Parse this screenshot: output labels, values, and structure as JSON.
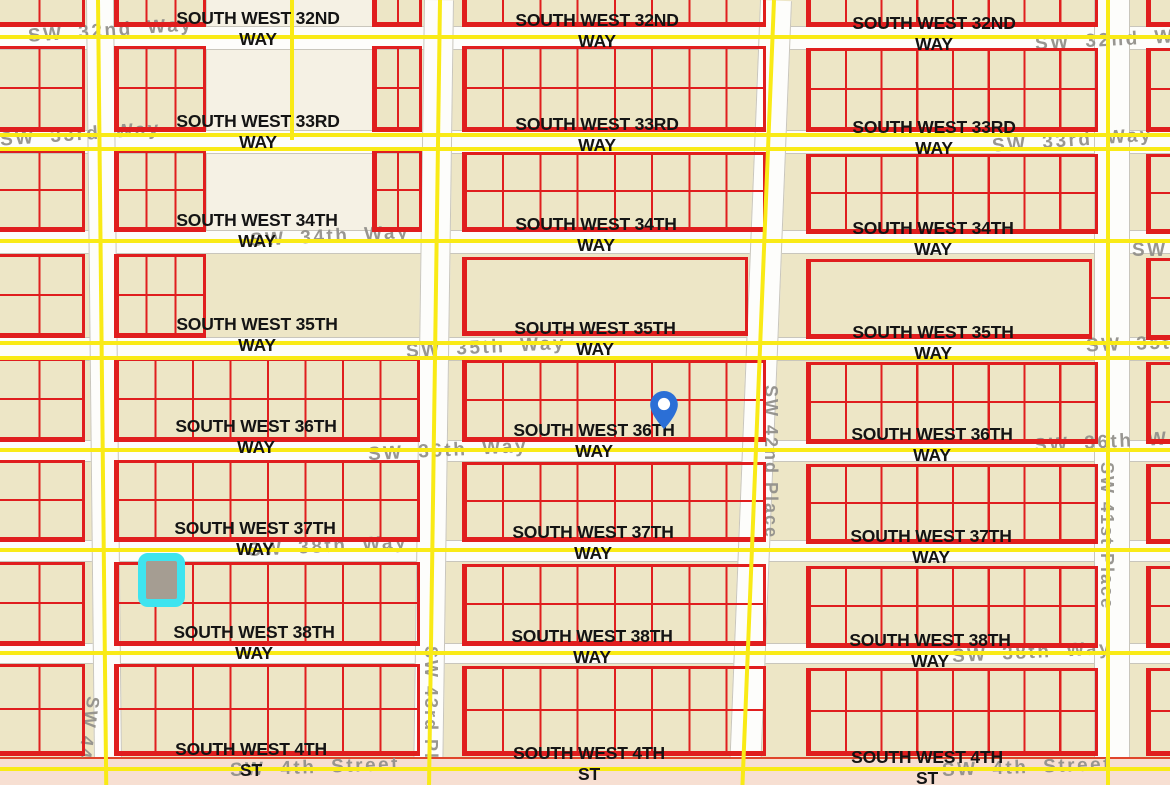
{
  "map": {
    "background": "#EDE6C6",
    "colors": {
      "parcel_red": "#E01E1E",
      "overlay_yellow": "#F9EA16",
      "street_white": "#FDFDFB",
      "street_casing_gray": "#C9C6BC",
      "bottom_street_salmon": "#F7DFD2",
      "bottom_street_casing": "#E0452B",
      "black_label": "#141414",
      "gray_label": "#93918C",
      "pin_blue": "#2B6FD6",
      "highlight_cyan": "#3EE4EF",
      "highlight_fill": "#A59D92"
    },
    "streets_h": [
      {
        "y": 26,
        "h": 22
      },
      {
        "y": 130,
        "h": 22
      },
      {
        "y": 230,
        "h": 22
      },
      {
        "y": 337,
        "h": 22
      },
      {
        "y": 440,
        "h": 20
      },
      {
        "y": 540,
        "h": 20
      },
      {
        "y": 643,
        "h": 19
      }
    ],
    "streets_v": [
      {
        "x": 86,
        "w": 26,
        "rot": -0.6
      },
      {
        "x": 424,
        "w": 28,
        "rot": 0.8
      },
      {
        "x": 760,
        "w": 30,
        "rot": 2.3
      },
      {
        "x": 1094,
        "w": 34,
        "rot": 0
      }
    ],
    "top_strip": {
      "x": 206,
      "y": 0,
      "w": 166,
      "h": 240
    },
    "bottom_street": {
      "y": 757,
      "h": 28
    },
    "yellow_h": [
      35,
      133,
      147,
      239,
      341,
      356,
      448,
      548,
      651,
      767
    ],
    "yellow_v": [
      {
        "x": 96,
        "y": 0,
        "h": 790,
        "rot": -0.6
      },
      {
        "x": 290,
        "y": 0,
        "h": 140,
        "rot": 0
      },
      {
        "x": 438,
        "y": 0,
        "h": 790,
        "rot": 0.8
      },
      {
        "x": 772,
        "y": 0,
        "h": 790,
        "rot": 2.3
      },
      {
        "x": 1106,
        "y": 0,
        "h": 790,
        "rot": 0
      }
    ],
    "blocks": [
      {
        "x": -8,
        "y": -6,
        "w": 93,
        "h": 33,
        "cols": 2,
        "rows": 1
      },
      {
        "x": 114,
        "y": -6,
        "w": 92,
        "h": 33,
        "cols": 3,
        "rows": 1
      },
      {
        "x": 372,
        "y": -6,
        "w": 50,
        "h": 33,
        "cols": 2,
        "rows": 1
      },
      {
        "x": 462,
        "y": -6,
        "w": 304,
        "h": 33,
        "cols": 8,
        "rows": 1
      },
      {
        "x": 806,
        "y": -6,
        "w": 292,
        "h": 33,
        "cols": 8,
        "rows": 1
      },
      {
        "x": 1146,
        "y": -6,
        "w": 30,
        "h": 33,
        "cols": 1,
        "rows": 1
      },
      {
        "x": -8,
        "y": 46,
        "w": 93,
        "h": 86,
        "cols": 2,
        "rows": 2
      },
      {
        "x": 114,
        "y": 46,
        "w": 92,
        "h": 86,
        "cols": 3,
        "rows": 2
      },
      {
        "x": 372,
        "y": 46,
        "w": 50,
        "h": 86,
        "cols": 2,
        "rows": 2
      },
      {
        "x": 462,
        "y": 46,
        "w": 304,
        "h": 86,
        "cols": 8,
        "rows": 2
      },
      {
        "x": 806,
        "y": 48,
        "w": 292,
        "h": 84,
        "cols": 8,
        "rows": 2
      },
      {
        "x": 1146,
        "y": 48,
        "w": 30,
        "h": 84,
        "cols": 1,
        "rows": 2
      },
      {
        "x": -8,
        "y": 150,
        "w": 93,
        "h": 82,
        "cols": 2,
        "rows": 2
      },
      {
        "x": 114,
        "y": 150,
        "w": 92,
        "h": 82,
        "cols": 3,
        "rows": 2
      },
      {
        "x": 372,
        "y": 150,
        "w": 50,
        "h": 82,
        "cols": 2,
        "rows": 2
      },
      {
        "x": 462,
        "y": 152,
        "w": 304,
        "h": 80,
        "cols": 8,
        "rows": 2
      },
      {
        "x": 806,
        "y": 154,
        "w": 292,
        "h": 80,
        "cols": 8,
        "rows": 2
      },
      {
        "x": 1146,
        "y": 154,
        "w": 30,
        "h": 80,
        "cols": 1,
        "rows": 2
      },
      {
        "x": -8,
        "y": 254,
        "w": 93,
        "h": 84,
        "cols": 2,
        "rows": 2
      },
      {
        "x": 114,
        "y": 254,
        "w": 92,
        "h": 84,
        "cols": 3,
        "rows": 2
      },
      {
        "x": 462,
        "y": 257,
        "w": 286,
        "h": 79,
        "cols": 1,
        "rows": 1
      },
      {
        "x": 806,
        "y": 259,
        "w": 286,
        "h": 80,
        "cols": 1,
        "rows": 1
      },
      {
        "x": 1146,
        "y": 258,
        "w": 30,
        "h": 82,
        "cols": 1,
        "rows": 2
      },
      {
        "x": -8,
        "y": 358,
        "w": 93,
        "h": 84,
        "cols": 2,
        "rows": 2
      },
      {
        "x": 114,
        "y": 358,
        "w": 306,
        "h": 84,
        "cols": 8,
        "rows": 2
      },
      {
        "x": 462,
        "y": 360,
        "w": 304,
        "h": 82,
        "cols": 8,
        "rows": 2
      },
      {
        "x": 806,
        "y": 362,
        "w": 292,
        "h": 82,
        "cols": 8,
        "rows": 2
      },
      {
        "x": 1146,
        "y": 362,
        "w": 30,
        "h": 82,
        "cols": 1,
        "rows": 2
      },
      {
        "x": -8,
        "y": 460,
        "w": 93,
        "h": 82,
        "cols": 2,
        "rows": 2
      },
      {
        "x": 114,
        "y": 460,
        "w": 306,
        "h": 82,
        "cols": 8,
        "rows": 2
      },
      {
        "x": 462,
        "y": 462,
        "w": 304,
        "h": 80,
        "cols": 8,
        "rows": 2
      },
      {
        "x": 806,
        "y": 464,
        "w": 292,
        "h": 80,
        "cols": 8,
        "rows": 2
      },
      {
        "x": 1146,
        "y": 464,
        "w": 30,
        "h": 80,
        "cols": 1,
        "rows": 2
      },
      {
        "x": -8,
        "y": 562,
        "w": 93,
        "h": 84,
        "cols": 2,
        "rows": 2
      },
      {
        "x": 114,
        "y": 562,
        "w": 306,
        "h": 84,
        "cols": 8,
        "rows": 2
      },
      {
        "x": 462,
        "y": 564,
        "w": 304,
        "h": 82,
        "cols": 8,
        "rows": 2
      },
      {
        "x": 806,
        "y": 566,
        "w": 292,
        "h": 82,
        "cols": 8,
        "rows": 2
      },
      {
        "x": 1146,
        "y": 566,
        "w": 30,
        "h": 82,
        "cols": 1,
        "rows": 2
      },
      {
        "x": -8,
        "y": 664,
        "w": 93,
        "h": 92,
        "cols": 2,
        "rows": 2
      },
      {
        "x": 114,
        "y": 664,
        "w": 306,
        "h": 92,
        "cols": 8,
        "rows": 2
      },
      {
        "x": 462,
        "y": 666,
        "w": 304,
        "h": 90,
        "cols": 8,
        "rows": 2
      },
      {
        "x": 806,
        "y": 668,
        "w": 292,
        "h": 88,
        "cols": 8,
        "rows": 2
      },
      {
        "x": 1146,
        "y": 668,
        "w": 30,
        "h": 88,
        "cols": 1,
        "rows": 2
      }
    ],
    "labels_black": [
      {
        "line1": "SOUTH WEST 32ND",
        "line2": "WAY",
        "cx": 258,
        "y": 8
      },
      {
        "line1": "SOUTH WEST 32ND",
        "line2": "WAY",
        "cx": 597,
        "y": 10
      },
      {
        "line1": "SOUTH WEST 32ND",
        "line2": "WAY",
        "cx": 934,
        "y": 13
      },
      {
        "line1": "SOUTH WEST 33RD",
        "line2": "WAY",
        "cx": 258,
        "y": 111
      },
      {
        "line1": "SOUTH WEST 33RD",
        "line2": "WAY",
        "cx": 597,
        "y": 114
      },
      {
        "line1": "SOUTH WEST 33RD",
        "line2": "WAY",
        "cx": 934,
        "y": 117
      },
      {
        "line1": "SOUTH WEST 34TH",
        "line2": "WAY",
        "cx": 257,
        "y": 210
      },
      {
        "line1": "SOUTH WEST 34TH",
        "line2": "WAY",
        "cx": 596,
        "y": 214
      },
      {
        "line1": "SOUTH WEST 34TH",
        "line2": "WAY",
        "cx": 933,
        "y": 218
      },
      {
        "line1": "SOUTH WEST 35TH",
        "line2": "WAY",
        "cx": 257,
        "y": 314
      },
      {
        "line1": "SOUTH WEST 35TH",
        "line2": "WAY",
        "cx": 595,
        "y": 318
      },
      {
        "line1": "SOUTH WEST 35TH",
        "line2": "WAY",
        "cx": 933,
        "y": 322
      },
      {
        "line1": "SOUTH WEST 36TH",
        "line2": "WAY",
        "cx": 256,
        "y": 416
      },
      {
        "line1": "SOUTH WEST 36TH",
        "line2": "WAY",
        "cx": 594,
        "y": 420
      },
      {
        "line1": "SOUTH WEST 36TH",
        "line2": "WAY",
        "cx": 932,
        "y": 424
      },
      {
        "line1": "SOUTH WEST 37TH",
        "line2": "WAY",
        "cx": 255,
        "y": 518
      },
      {
        "line1": "SOUTH WEST 37TH",
        "line2": "WAY",
        "cx": 593,
        "y": 522
      },
      {
        "line1": "SOUTH WEST 37TH",
        "line2": "WAY",
        "cx": 931,
        "y": 526
      },
      {
        "line1": "SOUTH WEST 38TH",
        "line2": "WAY",
        "cx": 254,
        "y": 622
      },
      {
        "line1": "SOUTH WEST 38TH",
        "line2": "WAY",
        "cx": 592,
        "y": 626
      },
      {
        "line1": "SOUTH WEST 38TH",
        "line2": "WAY",
        "cx": 930,
        "y": 630
      },
      {
        "line1": "SOUTH WEST 4TH",
        "line2": "ST",
        "cx": 251,
        "y": 739
      },
      {
        "line1": "SOUTH WEST 4TH",
        "line2": "ST",
        "cx": 589,
        "y": 743
      },
      {
        "line1": "SOUTH WEST 4TH",
        "line2": "ST",
        "cx": 927,
        "y": 747
      }
    ],
    "labels_gray": [
      {
        "text": "SW 32nd Way",
        "x": 28,
        "y": 20,
        "rot": -4
      },
      {
        "text": "SW 32nd W",
        "x": 1035,
        "y": 30,
        "rot": -3
      },
      {
        "text": "SW 33rd Way",
        "x": 0,
        "y": 124,
        "rot": -4
      },
      {
        "text": "SW 33rd Way",
        "x": 992,
        "y": 130,
        "rot": -4
      },
      {
        "text": "SW 34th Way",
        "x": 250,
        "y": 226,
        "rot": -3
      },
      {
        "text": "SW",
        "x": 1132,
        "y": 240,
        "rot": 0
      },
      {
        "text": "SW 35th Way",
        "x": 406,
        "y": 337,
        "rot": -3
      },
      {
        "text": "SW 35t",
        "x": 1086,
        "y": 334,
        "rot": -2
      },
      {
        "text": "SW 36th Way",
        "x": 368,
        "y": 440,
        "rot": -3
      },
      {
        "text": "SW 36th W",
        "x": 1034,
        "y": 432,
        "rot": -3
      },
      {
        "text": "SW 38th Way",
        "x": 248,
        "y": 536,
        "rot": -3
      },
      {
        "text": "SW 38th Way",
        "x": 952,
        "y": 642,
        "rot": -3
      },
      {
        "text": "SW 4th Street",
        "x": 230,
        "y": 757,
        "rot": -2
      },
      {
        "text": "SW 4th Street",
        "x": 942,
        "y": 757,
        "rot": -2
      }
    ],
    "labels_gray_vertical": [
      {
        "text": "SW 42nd Place",
        "x": 760,
        "y": 385,
        "h": 185,
        "rot": 0
      },
      {
        "text": "SW 43rd Pl",
        "x": 420,
        "y": 646,
        "h": 142,
        "rot": 0
      },
      {
        "text": "SW 41st Place",
        "x": 1096,
        "y": 462,
        "h": 200,
        "rot": 0
      },
      {
        "text": "SW 44",
        "x": 76,
        "y": 696,
        "h": 92,
        "rot": 8
      }
    ],
    "pin": {
      "x": 650,
      "y": 391,
      "w": 28,
      "h": 38
    },
    "highlight": {
      "x": 138,
      "y": 553,
      "w": 47,
      "h": 54
    }
  }
}
